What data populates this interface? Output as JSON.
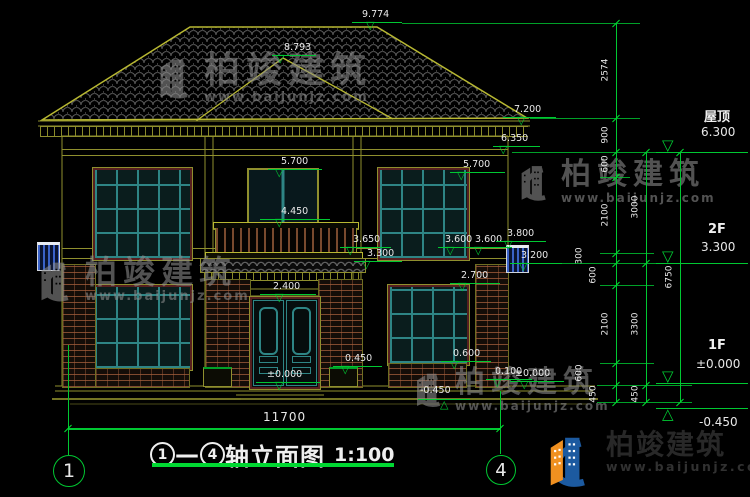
{
  "colors": {
    "background": "#000000",
    "cad_olive": "#8f8f2e",
    "cad_bright_olive": "#b8b832",
    "dim_green": "#00c832",
    "text_white": "#e8e8e8",
    "lattice_teal": "#2e8585",
    "window_trim_maroon": "#571f1f",
    "brick_red": "#a55f3c",
    "tile_gray": "#5f5f5f",
    "ac_unit_blue": "#3a62c8",
    "watermark_gray": "#8d8d8d",
    "logo_blue": "#1c5aa0",
    "logo_orange": "#f09020",
    "footer_text_dark": "#282828"
  },
  "drawing_title": {
    "axis_from": "1",
    "axis_to": "4",
    "dash": "—",
    "name": "轴立面图",
    "scale": "1:100"
  },
  "overall_width_dim": {
    "value": "11700"
  },
  "axis_bubbles": [
    {
      "label": "1",
      "cx": 68,
      "cy": 470,
      "r": 15,
      "line_y1": 345,
      "line_y2": 455
    },
    {
      "label": "4",
      "cx": 500,
      "cy": 469,
      "r": 14,
      "line_y1": 391,
      "line_y2": 454
    }
  ],
  "elevation_markers": [
    {
      "value": "9.774",
      "x1": 352,
      "x2": 402,
      "ly": 22,
      "tx": 372,
      "lx": 362,
      "lyt": 10
    },
    {
      "value": "8.793",
      "x1": 272,
      "x2": 316,
      "ly": 55,
      "tx": 282,
      "lx": 284,
      "lyt": 43
    },
    {
      "value": "7.200",
      "x1": 503,
      "x2": 556,
      "ly": 117,
      "tx": 523,
      "lx": 514,
      "lyt": 105
    },
    {
      "value": "6.350",
      "x1": 493,
      "x2": 540,
      "ly": 146,
      "tx": 505,
      "lx": 501,
      "lyt": 134
    },
    {
      "value": "5.700",
      "x1": 268,
      "x2": 322,
      "ly": 169,
      "tx": 281,
      "lx": 281,
      "lyt": 157
    },
    {
      "value": "5.700",
      "x1": 450,
      "x2": 505,
      "ly": 172,
      "tx": 463,
      "lx": 463,
      "lyt": 160
    },
    {
      "value": "4.450",
      "x1": 260,
      "x2": 330,
      "ly": 219,
      "tx": 281,
      "lx": 281,
      "lyt": 207
    },
    {
      "value": "3.650",
      "x1": 340,
      "x2": 391,
      "ly": 247,
      "tx": 352,
      "lx": 353,
      "lyt": 235
    },
    {
      "value": "3.300",
      "x1": 354,
      "x2": 402,
      "ly": 261,
      "tx": 368,
      "lx": 367,
      "lyt": 249
    },
    {
      "value": "3.600",
      "x1": 438,
      "x2": 487,
      "ly": 247,
      "tx": 452,
      "lx": 445,
      "lyt": 235
    },
    {
      "value": "3.600",
      "x1": 466,
      "x2": 512,
      "ly": 247,
      "tx": 480,
      "lx": 475,
      "lyt": 235
    },
    {
      "value": "3.800",
      "x1": 496,
      "x2": 546,
      "ly": 241,
      "tx": 510,
      "lx": 507,
      "lyt": 229
    },
    {
      "value": "3.200",
      "x1": 510,
      "x2": 562,
      "ly": 263,
      "tx": 525,
      "lx": 521,
      "lyt": 251
    },
    {
      "value": "2.700",
      "x1": 450,
      "x2": 500,
      "ly": 283,
      "tx": 464,
      "lx": 461,
      "lyt": 271
    },
    {
      "value": "2.400",
      "x1": 260,
      "x2": 316,
      "ly": 294,
      "tx": 281,
      "lx": 273,
      "lyt": 282
    },
    {
      "value": "0.450",
      "x1": 333,
      "x2": 382,
      "ly": 366,
      "tx": 347,
      "lx": 345,
      "lyt": 354
    },
    {
      "value": "0.600",
      "x1": 441,
      "x2": 491,
      "ly": 361,
      "tx": 456,
      "lx": 453,
      "lyt": 349
    },
    {
      "value": "0.100",
      "x1": 486,
      "x2": 532,
      "ly": 379,
      "tx": 499,
      "lx": 495,
      "lyt": 367
    },
    {
      "value": "±0.000",
      "x1": 256,
      "x2": 320,
      "ly": 382,
      "tx": 281,
      "lx": 267,
      "lyt": 370
    },
    {
      "value": "±0.000",
      "x1": 510,
      "x2": 564,
      "ly": 381,
      "tx": 526,
      "lx": 515,
      "lyt": 369
    },
    {
      "value": "-0.450",
      "x1": 418,
      "x2": 470,
      "ly": 399,
      "tx": 446,
      "lx": 420,
      "lyt": 386,
      "inverted": true
    }
  ],
  "floor_levels": [
    {
      "name": "屋顶",
      "elev": "6.300",
      "line_y": 152,
      "name_x": 704,
      "name_y": 106,
      "elev_x": 701,
      "elev_y": 125,
      "tri_x": 662
    },
    {
      "name": "2F",
      "elev": "3.300",
      "line_y": 263,
      "name_x": 708,
      "name_y": 222,
      "elev_x": 701,
      "elev_y": 240,
      "tri_x": 662
    },
    {
      "name": "1F",
      "elev": "±0.000",
      "line_y": 383,
      "name_x": 708,
      "name_y": 338,
      "elev_x": 696,
      "elev_y": 357,
      "tri_x": 662
    },
    {
      "name": "",
      "elev": "-0.450",
      "line_y": 408,
      "name_x": 0,
      "name_y": 0,
      "elev_x": 699,
      "elev_y": 415,
      "tri_x": 662,
      "inverted": true
    }
  ],
  "dimension_chains": [
    {
      "x": 616,
      "y1": 23,
      "y2": 402,
      "ticks": [
        23,
        118,
        152,
        177,
        253,
        263,
        285,
        363,
        385,
        402
      ],
      "segments": [
        {
          "v": "2574",
          "y": 70,
          "dx": 0
        },
        {
          "v": "900",
          "y": 135,
          "dx": 0
        },
        {
          "v": "600",
          "y": 164,
          "dx": 0
        },
        {
          "v": "2100",
          "y": 215,
          "dx": 0
        },
        {
          "v": "300",
          "y": 256,
          "dx": -26
        },
        {
          "v": "600",
          "y": 275,
          "dx": -12
        },
        {
          "v": "2100",
          "y": 324,
          "dx": 0
        },
        {
          "v": "600",
          "y": 373,
          "dx": -26
        },
        {
          "v": "450",
          "y": 394,
          "dx": -12
        }
      ]
    },
    {
      "x": 646,
      "y1": 152,
      "y2": 402,
      "ticks": [
        152,
        263,
        385,
        402
      ],
      "segments": [
        {
          "v": "3000",
          "y": 207,
          "dx": 0
        },
        {
          "v": "3300",
          "y": 324,
          "dx": 0
        },
        {
          "v": "450",
          "y": 394,
          "dx": 0
        }
      ]
    },
    {
      "x": 680,
      "y1": 152,
      "y2": 402,
      "ticks": [
        152,
        402
      ],
      "segments": [
        {
          "v": "6750",
          "y": 277,
          "dx": 0
        }
      ]
    }
  ],
  "extension_lines": [
    {
      "x1": 402,
      "x2": 640,
      "y": 23
    },
    {
      "x1": 530,
      "x2": 640,
      "y": 118
    },
    {
      "x1": 512,
      "x2": 692,
      "y": 152
    },
    {
      "x1": 600,
      "x2": 630,
      "y": 177
    },
    {
      "x1": 600,
      "x2": 654,
      "y": 253
    },
    {
      "x1": 512,
      "x2": 692,
      "y": 263
    },
    {
      "x1": 600,
      "x2": 654,
      "y": 285
    },
    {
      "x1": 600,
      "x2": 654,
      "y": 363
    },
    {
      "x1": 597,
      "x2": 692,
      "y": 385
    },
    {
      "x1": 597,
      "x2": 692,
      "y": 402
    }
  ],
  "watermark": {
    "brand": "柏竣建筑",
    "url": "www.baijunjz.com"
  },
  "watermark_instances": [
    {
      "x": 143,
      "y": 53,
      "logo": 56,
      "fs": 36,
      "ufs": 13
    },
    {
      "x": 506,
      "y": 160,
      "logo": 50,
      "fs": 30,
      "ufs": 12
    },
    {
      "x": 24,
      "y": 256,
      "logo": 56,
      "fs": 32,
      "ufs": 13
    },
    {
      "x": 402,
      "y": 368,
      "logo": 48,
      "fs": 30,
      "ufs": 12
    }
  ],
  "footer_brand": {
    "brand": "柏竣建筑",
    "url": "www.baijunjz.com"
  }
}
